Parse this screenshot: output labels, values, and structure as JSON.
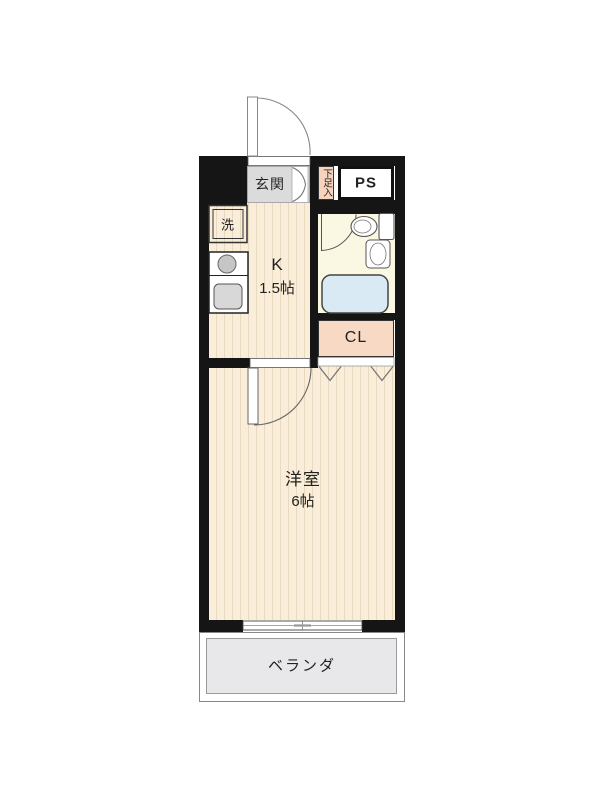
{
  "type": "apartment-floor-plan",
  "colors": {
    "wall": "#151515",
    "floor": "#FAEDD9",
    "floor_stripe": "#E8DABF",
    "genkan": "#DBDBDB",
    "bathroom": "#FAF7E2",
    "bathtub": "#D9EAF5",
    "closet": "#F7D9C4",
    "shoe_box": "#F6D3BC",
    "veranda": "#E8E8EA"
  },
  "rooms": {
    "genkan": {
      "label": "玄関"
    },
    "shoe_box": {
      "label": "下足入"
    },
    "pipe_space": {
      "label": "PS"
    },
    "washer": {
      "label": "洗"
    },
    "kitchen": {
      "label": "K",
      "size": "1.5帖"
    },
    "closet": {
      "label": "CL"
    },
    "western_room": {
      "label": "洋室",
      "size": "6帖"
    },
    "veranda": {
      "label": "ベランダ"
    }
  }
}
